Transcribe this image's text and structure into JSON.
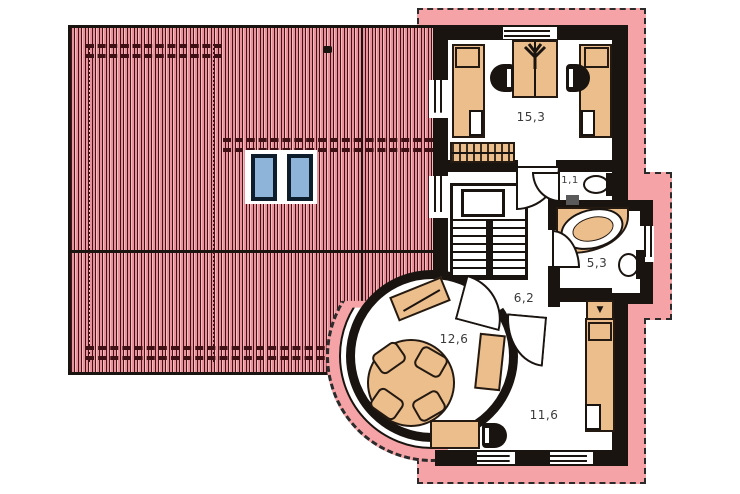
{
  "plan": {
    "title": "upper-floor-plan",
    "rooms": [
      {
        "id": "bedroom-top",
        "area": "15,3"
      },
      {
        "id": "wc",
        "area": "1,1"
      },
      {
        "id": "bathroom",
        "area": "5,3"
      },
      {
        "id": "hall",
        "area": "6,2"
      },
      {
        "id": "tower-room",
        "area": "12,6"
      },
      {
        "id": "bedroom-bottom",
        "area": "11,6"
      }
    ],
    "icons": {
      "wardrobe_marker": "▼"
    },
    "colors": {
      "roof_stripe_pink": "#e8939b",
      "exterior_band_pink": "#f5a3a6",
      "furniture_tan": "#ecbe8c",
      "wall_black": "#1a1410",
      "skylight_blue": "#8fb4d9",
      "label_gray": "#3a3a3a"
    }
  }
}
